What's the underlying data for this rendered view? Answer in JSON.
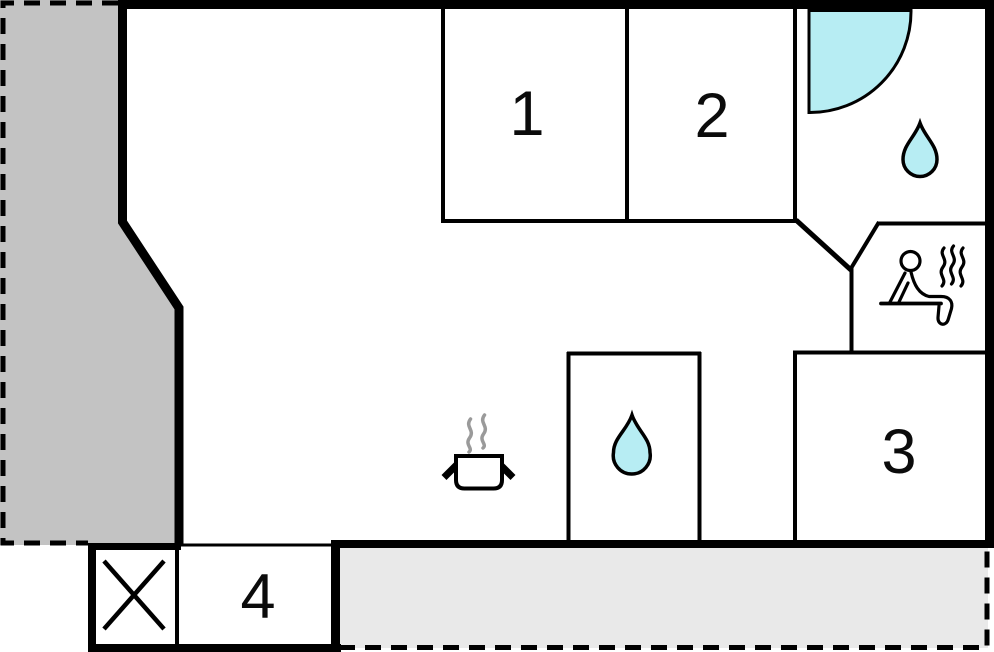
{
  "rooms": [
    {
      "label": "1"
    },
    {
      "label": "2"
    },
    {
      "label": "3"
    },
    {
      "label": "4"
    }
  ],
  "icons": {
    "corner_shower": "quarter-circle-shower",
    "bathroom_water_drop": "water-drop",
    "wc_water_drop": "water-drop",
    "sauna": "person-on-sauna-bench-with-heat-waves",
    "kitchen_stove": "cooking-pot-with-steam",
    "entrance_cross": "crossed-box"
  },
  "colors": {
    "water": "#b7edf3",
    "terrace_dark": "#c3c3c3",
    "terrace_light": "#e9e9e9",
    "wall": "#000000",
    "steam": "#9a9a9a",
    "label": "#0b0b0b",
    "icon_fill": "#ffffff"
  }
}
